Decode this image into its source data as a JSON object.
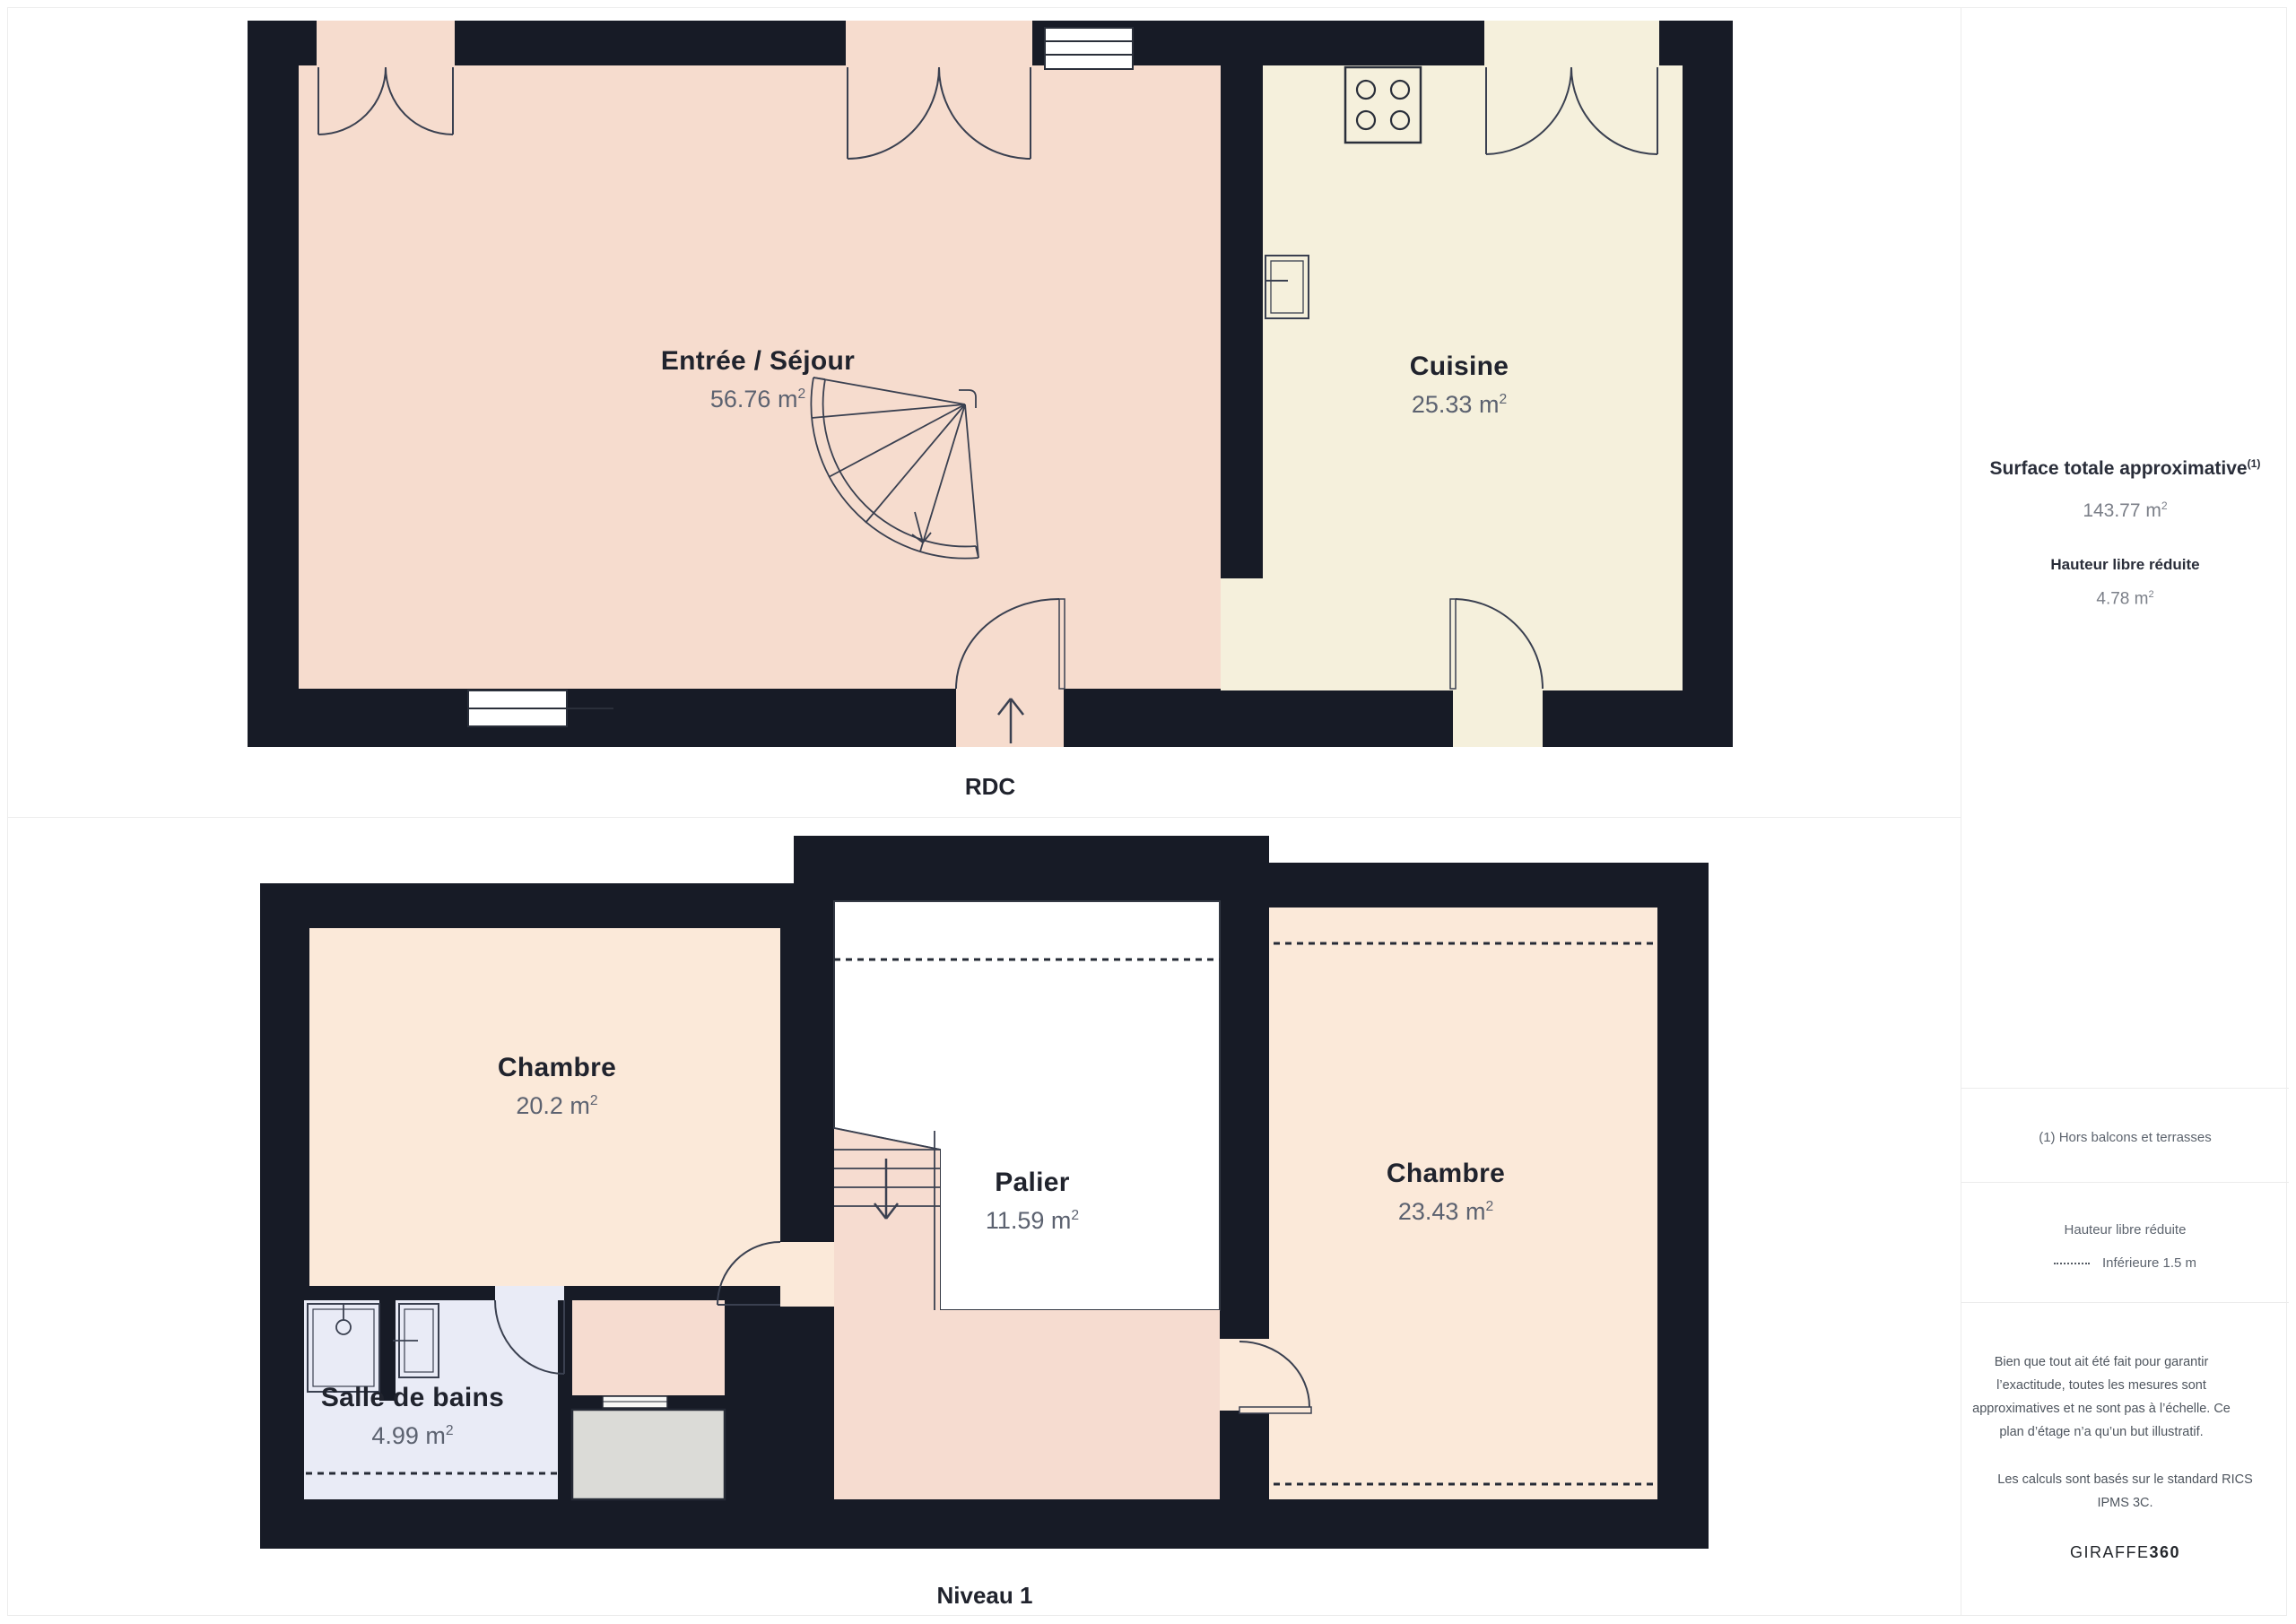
{
  "units": {
    "base": "m",
    "exp": "2"
  },
  "floors": [
    {
      "label": "RDC",
      "rooms": [
        {
          "name": "Entrée / Séjour",
          "area": "56.76"
        },
        {
          "name": "Cuisine",
          "area": "25.33"
        }
      ]
    },
    {
      "label": "Niveau 1",
      "rooms": [
        {
          "name": "Chambre",
          "area": "20.2"
        },
        {
          "name": "Palier",
          "area": "11.59"
        },
        {
          "name": "Chambre",
          "area": "23.43"
        },
        {
          "name": "Salle de bains",
          "area": "4.99"
        }
      ]
    }
  ],
  "sidebar": {
    "surface_title": "Surface totale approximative",
    "surface_footnote_marker": "(1)",
    "surface_value": "143.77",
    "reduced_height_title": "Hauteur libre réduite",
    "reduced_height_value": "4.78",
    "footnote": "(1) Hors balcons et terrasses",
    "legend_title": "Hauteur libre réduite",
    "legend_item": "Inférieure 1.5 m",
    "disclaimer": "Bien que tout ait été fait pour garantir l’exactitude, toutes les mesures sont approximatives et ne sont pas à l’échelle. Ce plan d’étage n’a qu’un but illustratif.",
    "standard_note": "Les calculs sont basés sur le standard RICS IPMS 3C.",
    "brand_regular": "GIRAFFE",
    "brand_bold": "360"
  },
  "colors": {
    "wall": "#171B26",
    "sejour": "#F6DCCE",
    "cuisine": "#F5F0DC",
    "chambre": "#FBE9D9",
    "palier": "#F6DCD0",
    "salle_de_bains": "#E9EBF6",
    "storage": "#DBDBD7",
    "line": "#3A4050",
    "text_dark": "#20232D",
    "text_gray": "#5C6270"
  }
}
